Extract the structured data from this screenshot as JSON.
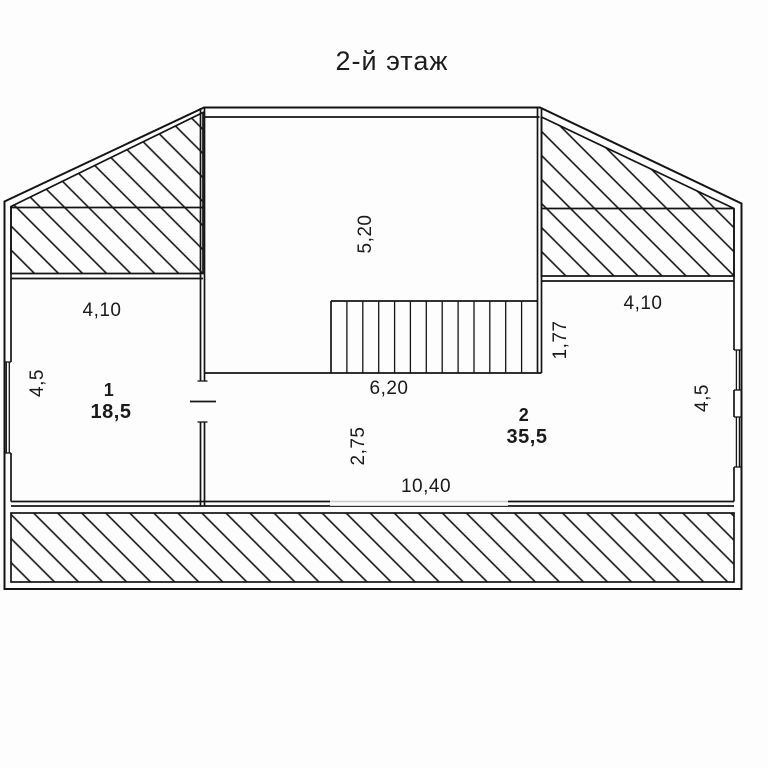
{
  "title": "2-й этаж",
  "colors": {
    "line": "#141414",
    "background": "#fdfdfd"
  },
  "floor_plan": {
    "rooms": [
      {
        "number": "1",
        "area": "18,5"
      },
      {
        "number": "2",
        "area": "35,5"
      }
    ],
    "dims": {
      "left_width": "4,10",
      "left_height": "4,5",
      "stairwell_depth": "5,20",
      "stairs_run": "6,20",
      "stairs_width": "1,77",
      "right_width": "4,10",
      "right_height": "4,5",
      "hall_depth": "2,75",
      "total_width": "10,40"
    }
  }
}
